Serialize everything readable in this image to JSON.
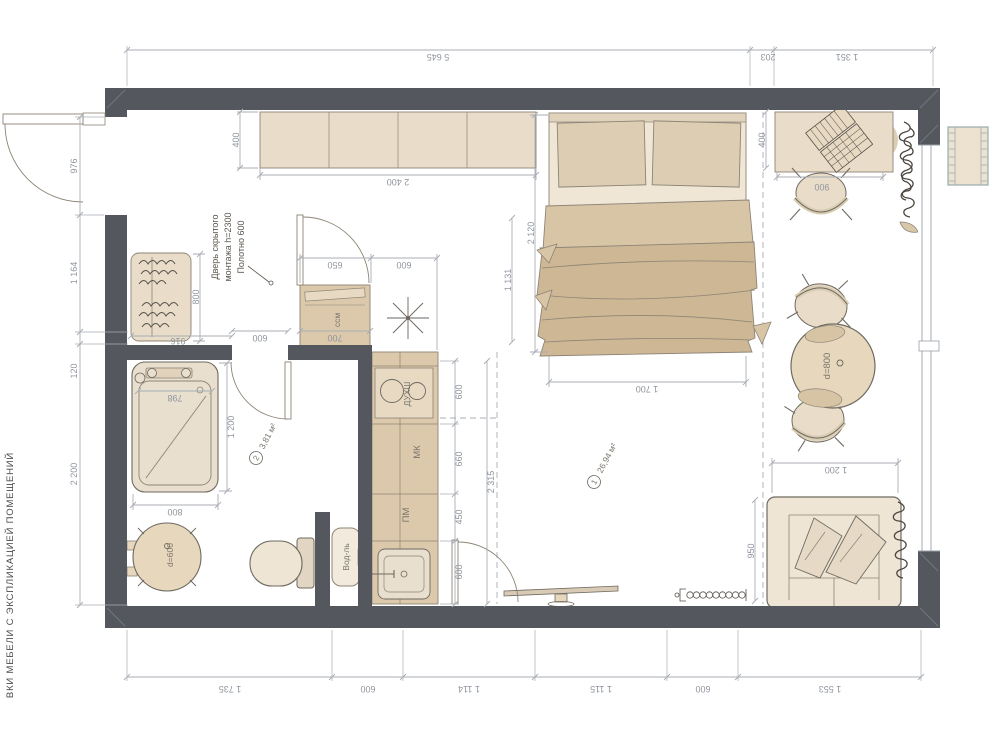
{
  "side_note": "ВКИ МЕБЕЛИ С ЭКСПЛИКАЦИЕЙ ПОМЕЩЕНИЙ",
  "door_note": {
    "l1": "Дверь скрытого",
    "l2": "монтажа h=2300",
    "l3": "Полотно 600"
  },
  "rooms": {
    "r1_num": "1",
    "r1_area": "26,94 м²",
    "r2_num": "2",
    "r2_area": "3,81 м²"
  },
  "appliances": {
    "ssm": "ссм",
    "oven": "ДУХШ",
    "mk": "МК",
    "pm": "ПМ",
    "heater": "Вод-ль",
    "table_small": "d=600",
    "table_big": "d=800"
  },
  "dims": {
    "top_total": "5 645",
    "top_203": "203",
    "top_1351": "1 351",
    "left_976": "976",
    "left_1164": "1 164",
    "left_120": "120",
    "left_2200": "2 200",
    "bottom_1735": "1 735",
    "bottom_600a": "600",
    "bottom_1114": "1 114",
    "bottom_1115": "1 115",
    "bottom_600b": "600",
    "bottom_1553": "1 553",
    "cab_depth": "400",
    "cab_width": "2 400",
    "wardrobe_800": "800",
    "wardrobe_916": "916",
    "bath_798": "798",
    "bath_1200": "1 200",
    "bath_800": "800",
    "door_600": "600",
    "ssm_650": "650",
    "ssm_700": "700",
    "kit_top_600": "600",
    "kit_600a": "600",
    "kit_660": "660",
    "kit_450": "450",
    "kit_600b": "600",
    "kit_total": "2 315",
    "pass_1131": "1 131",
    "bed_2120": "2 120",
    "bed_1700": "1 700",
    "desk_400": "400",
    "desk_900": "900",
    "sofa_1200": "1 200",
    "sofa_950": "950"
  },
  "colors": {
    "wall": "#54585e",
    "furn_light": "#ece3d2",
    "furn_tan": "#dcc9ab",
    "furn_mid": "#e6d7bd",
    "blanket": "#cdb794",
    "dim": "#a8adb5",
    "dim_text": "#8f959e",
    "sketch": "#6f6a60"
  }
}
